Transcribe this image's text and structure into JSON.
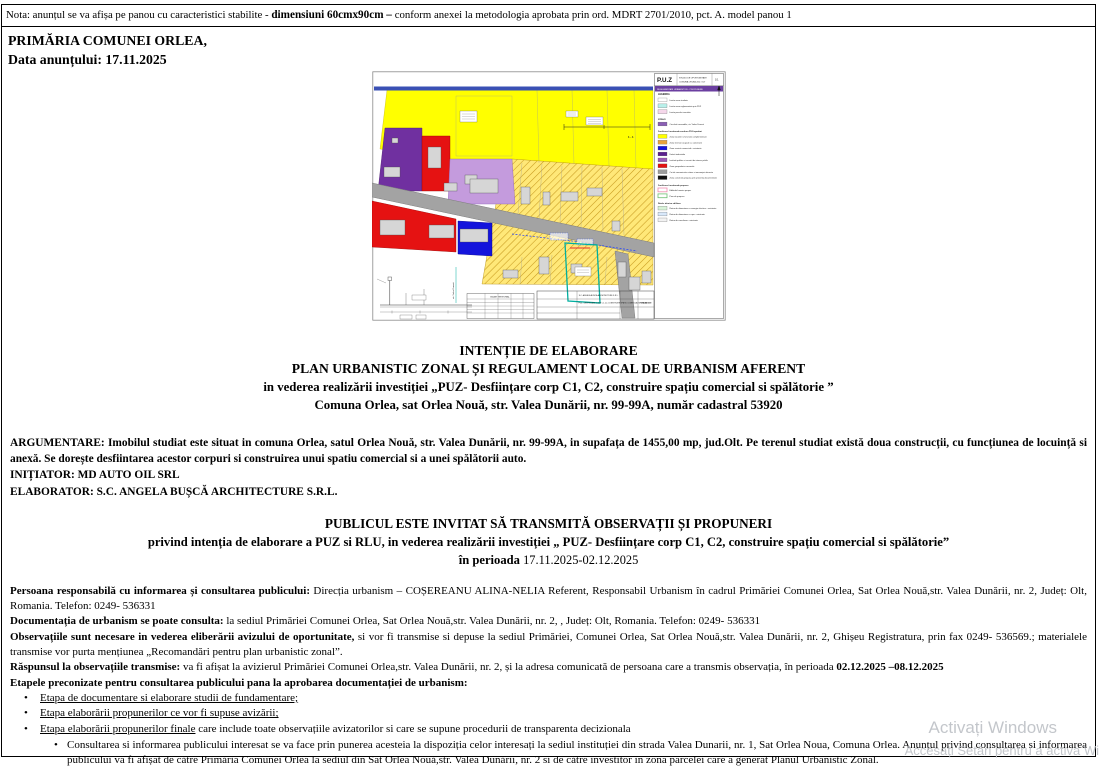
{
  "note": {
    "prefix": "Nota: anunțul se va afișa pe panou cu caracteristici stabilite - ",
    "bold": "dimensiuni 60cmx90cm – ",
    "suffix": "conform anexei la metodologia aprobata prin ord. MDRT 2701/2010, pct. A. model panou 1"
  },
  "header": {
    "line1": "PRIMĂRIA COMUNEI ORLEA,",
    "line2": "Data anunțului:  17.11.2025"
  },
  "map": {
    "title": "P.U.Z",
    "subtitle1": "STUDIU  DE  OPORTUNITATE",
    "subtitle2": "COMUNA ORLEA  JUD.  OLT",
    "page_no": "1/1",
    "sheet_label": "REGLEMENTARI URBANISTICE - PROPUNERE",
    "legend_title": "LEGENDA",
    "section_label": "1 - 1",
    "street_label": "str. Valea Dunarii",
    "table_title": "BILANT TERITORIAL",
    "cartouche_firm": "S.C. ANGELA BUSCA ARCHITECTURE S.R.L.",
    "cartouche_title": "PUZ - DESFIINTARE CORP C1, C2, CONSTRUIRE SPATIU COMERCIAL SI SPALATORIE",
    "cartouche_sheet": "PLANSA U1",
    "colors": {
      "zone_yellow": "#FFFF00",
      "zone_hatch_base": "#FFE878",
      "zone_purple": "#7030A0",
      "zone_lavender": "#C49BDD",
      "zone_red": "#E51212",
      "zone_blue": "#1414DC",
      "road_gray": "#A3A3A3",
      "building_gray": "#D6D6D6",
      "parcel_teal": "#00AFA0",
      "header_strip_blue": "#3A50B4",
      "legend_strip_purple": "#6B3FA0"
    },
    "legend_items": [
      {
        "t": "i",
        "c": "#FFFFFF",
        "l": "Limita zona studiata"
      },
      {
        "t": "i",
        "c": "#B9F0EA",
        "l": "Limita zona reglementata prin PUZ"
      },
      {
        "t": "i",
        "c": "#F5D7EA",
        "l": "Limita parcela investitie"
      },
      {
        "t": "h",
        "l": "STRAZI"
      },
      {
        "t": "i",
        "c": "#8B5FB5",
        "l": "Circulatii carosabile, str. Valea Dunarii"
      },
      {
        "t": "h",
        "l": "Zonificare functionala conform PUG aprobat"
      },
      {
        "t": "i",
        "c": "#FFFF00",
        "l": "Zona locuinte si functiuni complementare"
      },
      {
        "t": "i",
        "c": "#E8A33D",
        "l": "Zona terenuri ocupate cu constructii"
      },
      {
        "t": "i",
        "c": "#1414E0",
        "l": "Zona servicii comerciale - existente"
      },
      {
        "t": "i",
        "c": "#5B1F8F",
        "l": "Unitati industriale"
      },
      {
        "t": "i",
        "c": "#9B59B6",
        "l": "Institutii publice si servicii de interes public"
      },
      {
        "t": "i",
        "c": "#E21212",
        "l": "Zona gospodarie comunala"
      },
      {
        "t": "i",
        "c": "#9E9E9E",
        "l": "Cai de comunicatie rutiera si amenajari aferente"
      },
      {
        "t": "i",
        "c": "#111111",
        "l": "Zona construita propusa prin prezenta documentatie"
      },
      {
        "t": "h",
        "l": "Zonificare functionala propusa"
      },
      {
        "t": "io",
        "c": "#F08BB0",
        "l": "Edificabil maxim propus"
      },
      {
        "t": "io",
        "c": "#6FBF73",
        "l": "Parcela propusa"
      },
      {
        "t": "h",
        "l": "Retele tehnico edilitare"
      },
      {
        "t": "i",
        "c": "#D8F3D8",
        "l": "Retea de alimentare cu energie electrica - existenta"
      },
      {
        "t": "i",
        "c": "#D8E8FA",
        "l": "Retea de alimentare cu apa - existenta"
      },
      {
        "t": "i",
        "c": "#F2F2F2",
        "l": "Retea de canalizare - existenta"
      }
    ]
  },
  "title": {
    "l1": "INTENȚIE DE ELABORARE",
    "l2": "PLAN URBANISTIC ZONAL ȘI REGULAMENT LOCAL DE URBANISM AFERENT",
    "l3": "in vederea realizării investiției „PUZ- Desființare corp C1, C2, construire spațiu comercial si spălătorie ”",
    "l4": "Comuna Orlea, sat Orlea Nouă, str. Valea Dunării, nr. 99-99A, număr cadastral 53920"
  },
  "argumentare": {
    "text": "ARGUMENTARE:  Imobilul  studiat  este  situat  in  comuna  Orlea,  satul  Orlea  Nouă,  str.  Valea  Dunării,  nr.  99-99A,  in  supafața  de  1455,00  mp,  jud.Olt.   Pe terenul  studiat  există  doua construcții, cu funcțiunea  de locuință  si anexă. Se dorește desfiintarea acestor corpuri si  construirea unui spatiu comercial si a unei spălătorii auto.",
    "initiator": "INIȚIATOR:  MD AUTO OIL SRL",
    "elaborator": "ELABORATOR:  S.C.  ANGELA  BUȘCĂ  ARCHITECTURE   S.R.L."
  },
  "invitation": {
    "l1": "PUBLICUL ESTE INVITAT SĂ TRANSMITĂ OBSERVAȚII ȘI PROPUNERI",
    "l2": "privind intenția  de elaborare a PUZ si RLU, in vederea realizării investiției „ PUZ- Desființare corp C1, C2, construire spațiu comercial si spălătorie”",
    "l3_bold": "în perioada ",
    "l3_rest": "17.11.2025-02.12.2025"
  },
  "details": {
    "p1_lead": "Persoana responsabilă  cu informarea  și consultarea  publicului:",
    "p1_text": " Direcția urbanism   – COȘEREANU ALINA-NELIA Referent,  Responsabil  Urbanism  în cadrul  Primăriei  Comunei  Orlea,  Sat Orlea Nouă,str.  Valea Dunării, nr. 2, Județ:  Olt, Romania.   Telefon:  0249- 536331",
    "p2_lead": "Documentația  de urbanism  se poate  consulta:",
    "p2_text": " la sediul Primăriei  Comunei  Orlea, Sat Orlea Nouă,str.  Valea Dunării,  nr. 2, , Județ:  Olt, Romania.  Telefon:  0249- 536331",
    "p3_lead": "Observațiile sunt necesare  in vederea  eliberării  avizului  de oportunitate,",
    "p3_text": "  si vor fi transmise  si depuse  la sediul Primăriei,  Comunei  Orlea,  Sat Orlea Nouă,str.  Valea Dunării,  nr. 2,  Ghișeu  Registratura,  prin fax 0249- 536569.;  materialele  transmise  vor purta  mențiunea   „Recomandări  pentru  plan  urbanistic  zonal”.",
    "p4_lead": "Răspunsul la observațiile  transmise:",
    "p4_text": " va fi afișat  la avizierul  Primăriei  Comunei  Orlea,str.  Valea Dunării,  nr. 2, și la  adresa  comunicată  de persoana  care a transmis  observația,  în perioada ",
    "p4_dates": "02.12.2025  –08.12.2025",
    "p5": "Etapele preconizate  pentru  consultarea  publicului  pana la aprobarea  documentației  de urbanism:"
  },
  "etape": {
    "bullet_glyph": "•",
    "b1": "Etapa de documentare  si elaborare  studii  de fundamentare;",
    "b2": "Etapa elaborării  propunerilor  ce vor fi supuse  avizării;",
    "b3_u": "Etapa elaborării  propunerilor  finale",
    "b3_rest": " care  include  toate  observațiile   avizatorilor   si care se supune  procedurii  de transparenta  decizionala",
    "sub": "Consultarea  si informarea  publicului  interesat  se va face  prin  punerea  acesteia  la dispoziția  celor  interesați  la sediul  instituției  din  strada  Valea  Dunarii,  nr. 1, Sat Orlea  Noua, Comuna  Orlea. Anunțul  privind  consultarea  si informarea  publicului  va fi afișat  de către  Primăria  Comunei  Orlea  la sediul  din  Sat Orlea  Nouă,str.  Valea  Dunării,  nr. 2 si de către  investitor  in  zona parcelei  care  a generat  Planul  Urbanistic  Zonal."
  },
  "watermark": {
    "l1": "Activați Windows",
    "l2": "Accesați Setări pentru a activa Wi"
  }
}
